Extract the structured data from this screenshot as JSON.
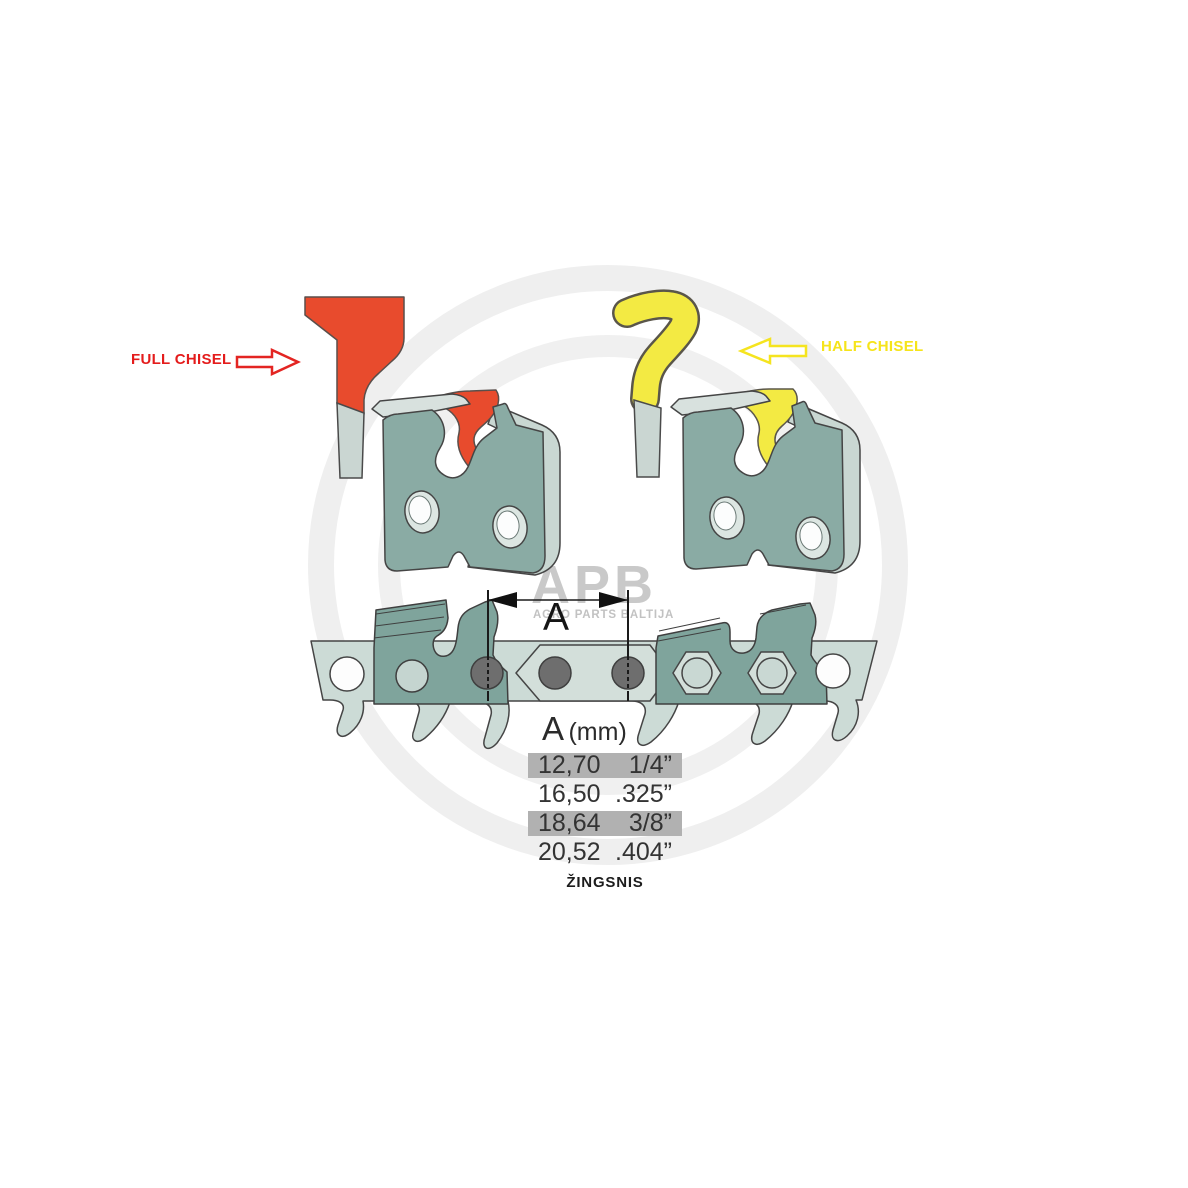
{
  "annotations": {
    "full_chisel": {
      "label": "FULL CHISEL",
      "color": "#e41c1c"
    },
    "half_chisel": {
      "label": "HALF CHISEL",
      "color": "#f6e41a"
    }
  },
  "watermark": {
    "logo": "APB",
    "subtitle": "AGRO PARTS BALTIJA"
  },
  "dimension": {
    "label": "A"
  },
  "pitch_table": {
    "header": {
      "symbol": "A",
      "unit": "(mm)"
    },
    "rows": [
      {
        "mm": "12,70",
        "inches": "1/4”",
        "shaded": true
      },
      {
        "mm": "16,50",
        "inches": ".325”",
        "shaded": false
      },
      {
        "mm": "18,64",
        "inches": "3/8”",
        "shaded": true
      },
      {
        "mm": "20,52",
        "inches": ".404”",
        "shaded": false
      }
    ],
    "caption": "ŽINGSNIS"
  },
  "colors": {
    "full_chisel_red": "#E84B2D",
    "half_chisel_yellow": "#F3EA43",
    "cutter_link_teal": "#8AABA4",
    "chain_plate_light": "#CCDBD6",
    "rivet_gray": "#6E6E6E",
    "table_row_shade": "#B1B1B1",
    "watermark_gray": "#C7C7C7"
  }
}
